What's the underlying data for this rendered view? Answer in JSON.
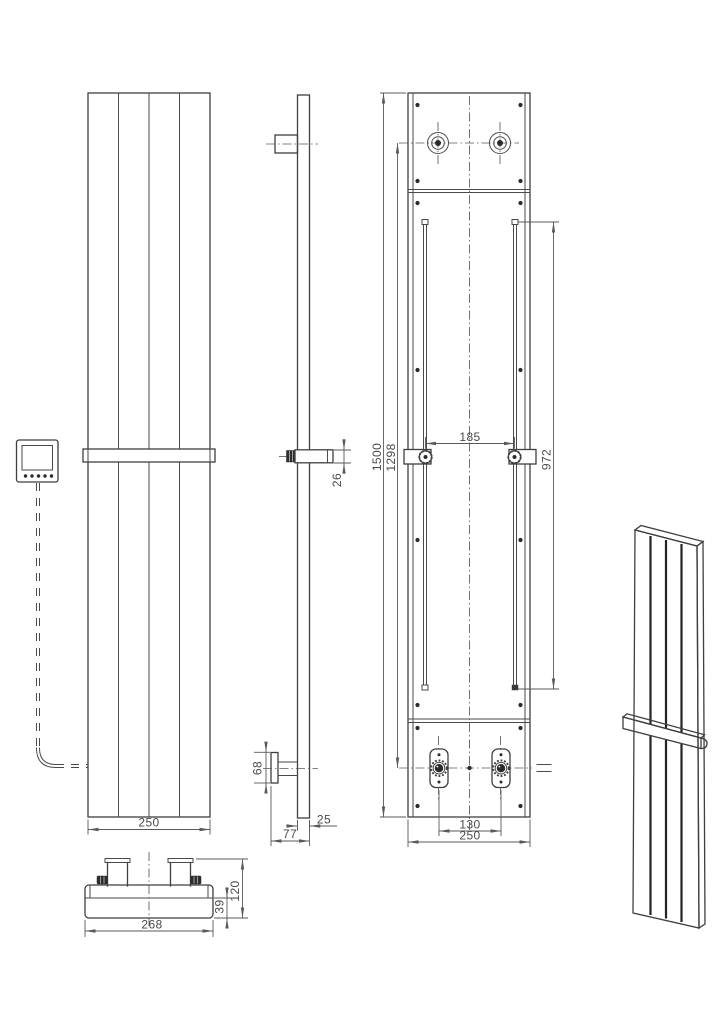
{
  "colors": {
    "background": "#ffffff",
    "line": "#3f3f3f",
    "dimension_line": "#5a5a5a",
    "dimension_text": "#4a4a4a"
  },
  "dims": {
    "front_width": "250",
    "towel_bar_height": "26",
    "bracket_plate_height": "68",
    "panel_thickness": "25",
    "total_depth": "77",
    "overall_height": "1500",
    "connection_height": "1298",
    "rail_spacing": "185",
    "rail_length": "972",
    "valve_spacing": "130",
    "rear_width": "250",
    "header_width": "268",
    "header_height": "120",
    "header_body_height": "39"
  }
}
